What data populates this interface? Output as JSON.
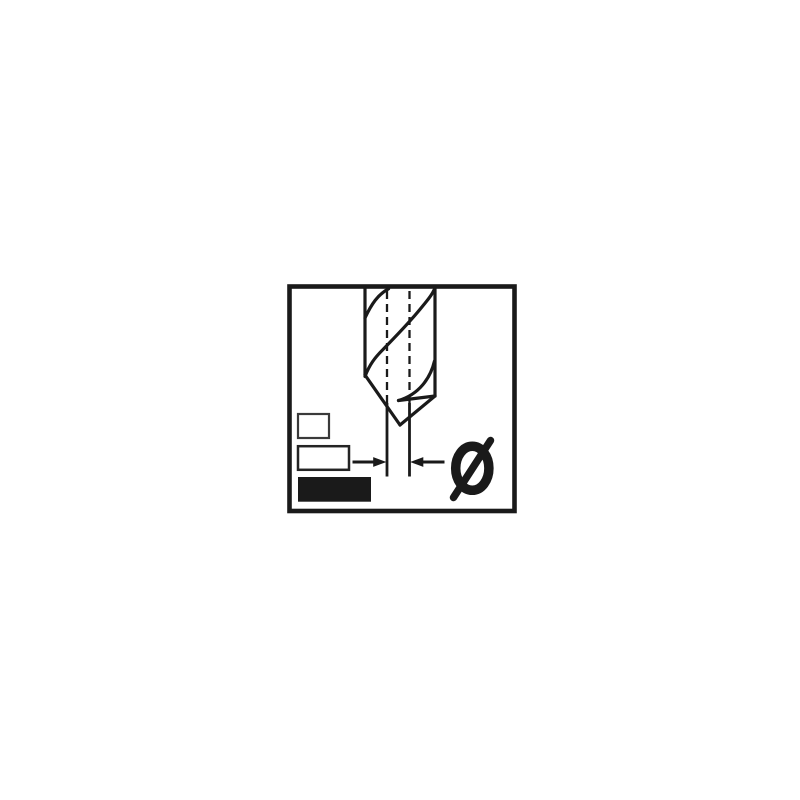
{
  "colors": {
    "background": "#ffffff",
    "ink": "#1a1a1a",
    "small_box_outline": "#3a3a3a",
    "medium_box_outline": "#242424"
  },
  "icons": {
    "diameter": "Ø"
  },
  "pictogram": {
    "description": "Twist drill bit shown point-down inside a square frame; dashed projection lines extend from the tip width, two opposing arrows point inward at the tip marking the drill diameter; three stacked size boxes at lower left with the largest filled solid; bold diameter symbol Ø at lower right.",
    "size_boxes": [
      {
        "size": "small",
        "style": "outlined"
      },
      {
        "size": "medium",
        "style": "outlined"
      },
      {
        "size": "large",
        "style": "filled"
      }
    ]
  }
}
